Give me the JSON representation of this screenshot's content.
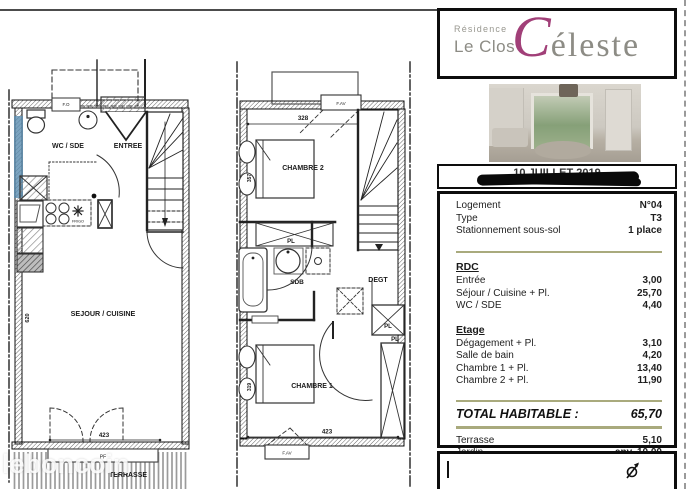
{
  "watermark": "leboncoin",
  "brand": {
    "residence": "Résidence",
    "name": "Le Clos",
    "logo_c": "C",
    "logo_rest": "éleste"
  },
  "date": {
    "text": "10 JUILLET 2019"
  },
  "info": {
    "rows": [
      {
        "label": "Logement",
        "value": "N°04"
      },
      {
        "label": "Type",
        "value": "T3"
      },
      {
        "label": "Stationnement sous-sol",
        "value": "1 place"
      }
    ]
  },
  "areas": {
    "rdc": {
      "title": "RDC",
      "rows": [
        {
          "label": "Entrée",
          "value": "3,00"
        },
        {
          "label": "Séjour / Cuisine + Pl.",
          "value": "25,70"
        },
        {
          "label": "WC / SDE",
          "value": "4,40"
        }
      ]
    },
    "etage": {
      "title": "Etage",
      "rows": [
        {
          "label": "Dégagement + Pl.",
          "value": "3,10"
        },
        {
          "label": "Salle de bain",
          "value": "4,20"
        },
        {
          "label": "Chambre 1 + Pl.",
          "value": "13,40"
        },
        {
          "label": "Chambre 2 + Pl.",
          "value": "11,90"
        }
      ]
    },
    "total": {
      "label": "TOTAL HABITABLE :",
      "value": "65,70"
    },
    "extras": [
      {
        "label": "Terrasse",
        "value": "5,10"
      },
      {
        "label": "Jardin",
        "value": "env. 10,00"
      }
    ]
  },
  "plan_rdc": {
    "rooms": {
      "wc_sde": "WC / SDE",
      "entree": "ENTREE",
      "sejour": "SEJOUR / CUISINE",
      "terrasse": "TERRASSE"
    },
    "labels": {
      "frigo": "FRIGO",
      "fo": "F.O",
      "pf": "PF"
    },
    "dims": {
      "width": "423",
      "height": "620"
    }
  },
  "plan_etage": {
    "rooms": {
      "chambre2": "CHAMBRE 2",
      "chambre1": "CHAMBRE 1",
      "sdb": "SDB",
      "degt": "DEGT"
    },
    "labels": {
      "pl": "PL",
      "fav": "F.AV"
    },
    "dims": {
      "top": "328",
      "chambre2_h": "357",
      "chambre1_h": "319",
      "bottom": "423"
    }
  },
  "colors": {
    "accent": "#a13f78",
    "divider": "#a9aa7d",
    "highlight_wall": "#5b8db0"
  }
}
